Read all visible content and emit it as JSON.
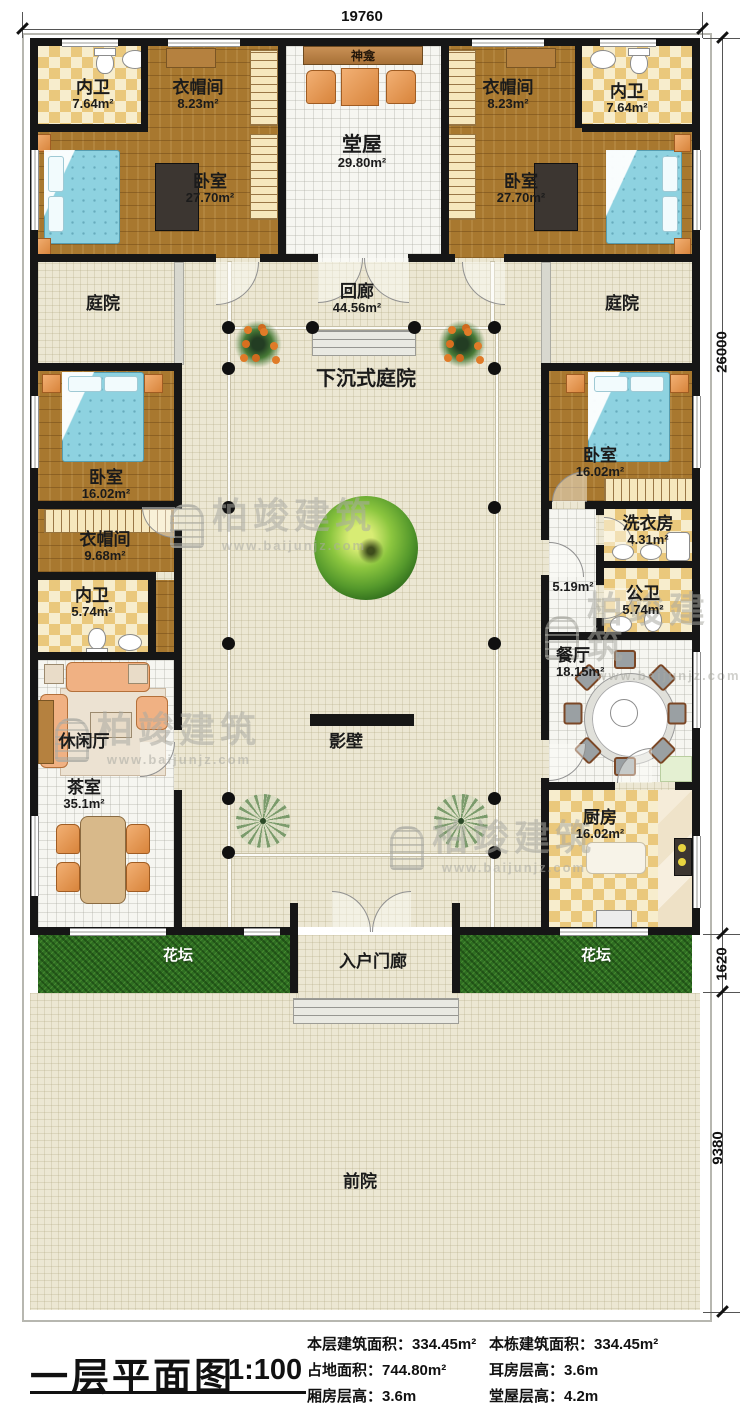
{
  "watermark": {
    "brand": "柏竣建筑",
    "url": "www.baijunjz.com"
  },
  "dimensions": {
    "top": "19760",
    "main_height": "26000",
    "flowerbed": "1620",
    "frontyard": "9380"
  },
  "rooms": {
    "neiwei_tl": {
      "label": "内卫",
      "area": "7.64m²"
    },
    "yimaojian_tl": {
      "label": "衣帽间",
      "area": "8.23m²"
    },
    "woshi_tl": {
      "label": "卧室",
      "area": "27.70m²"
    },
    "shenkan": {
      "label": "神龛"
    },
    "tangwu": {
      "label": "堂屋",
      "area": "29.80m²"
    },
    "yimaojian_tr": {
      "label": "衣帽间",
      "area": "8.23m²"
    },
    "neiwei_tr": {
      "label": "内卫",
      "area": "7.64m²"
    },
    "woshi_tr": {
      "label": "卧室",
      "area": "27.70m²"
    },
    "tingyuan_l": {
      "label": "庭院"
    },
    "huilang": {
      "label": "回廊",
      "area": "44.56m²"
    },
    "tingyuan_r": {
      "label": "庭院"
    },
    "woshi_ml": {
      "label": "卧室",
      "area": "16.02m²"
    },
    "sunken": {
      "label": "下沉式庭院"
    },
    "woshi_mr": {
      "label": "卧室",
      "area": "16.02m²"
    },
    "yimaojian_ml": {
      "label": "衣帽间",
      "area": "9.68m²"
    },
    "xiyifang": {
      "label": "洗衣房",
      "area": "4.31m²"
    },
    "neiwei_ml": {
      "label": "内卫",
      "area": "5.74m²"
    },
    "hallway": {
      "area": "5.19m²"
    },
    "gongwei": {
      "label": "公卫",
      "area": "5.74m²"
    },
    "canting": {
      "label": "餐厅",
      "area": "18.15m²"
    },
    "xiuxianting": {
      "label": "休闲厅"
    },
    "yingbi": {
      "label": "影壁"
    },
    "chashi": {
      "label": "茶室",
      "area": "35.1m²"
    },
    "chufang": {
      "label": "厨房",
      "area": "16.02m²"
    },
    "huatan_l": {
      "label": "花坛"
    },
    "rumenlang": {
      "label": "入户门廊"
    },
    "huatan_r": {
      "label": "花坛"
    },
    "qianyuan": {
      "label": "前院"
    }
  },
  "titleblock": {
    "title": "一层平面图",
    "scale": "1:100",
    "stats_left": [
      {
        "label": "本层建筑面积：",
        "value": "334.45m²"
      },
      {
        "label": "占地面积：",
        "value": "744.80m²"
      },
      {
        "label": "厢房层高：",
        "value": "3.6m"
      }
    ],
    "stats_right": [
      {
        "label": "本栋建筑面积：",
        "value": "334.45m²"
      },
      {
        "label": "耳房层高：",
        "value": "3.6m"
      },
      {
        "label": "堂屋层高：",
        "value": "4.2m"
      }
    ]
  },
  "colors": {
    "wall": "#161616",
    "wood": "#a8782f",
    "checker": "#eac87c",
    "grass": "#2f6e22",
    "bed": "#8ed2e0",
    "accent": "#d8843b"
  }
}
